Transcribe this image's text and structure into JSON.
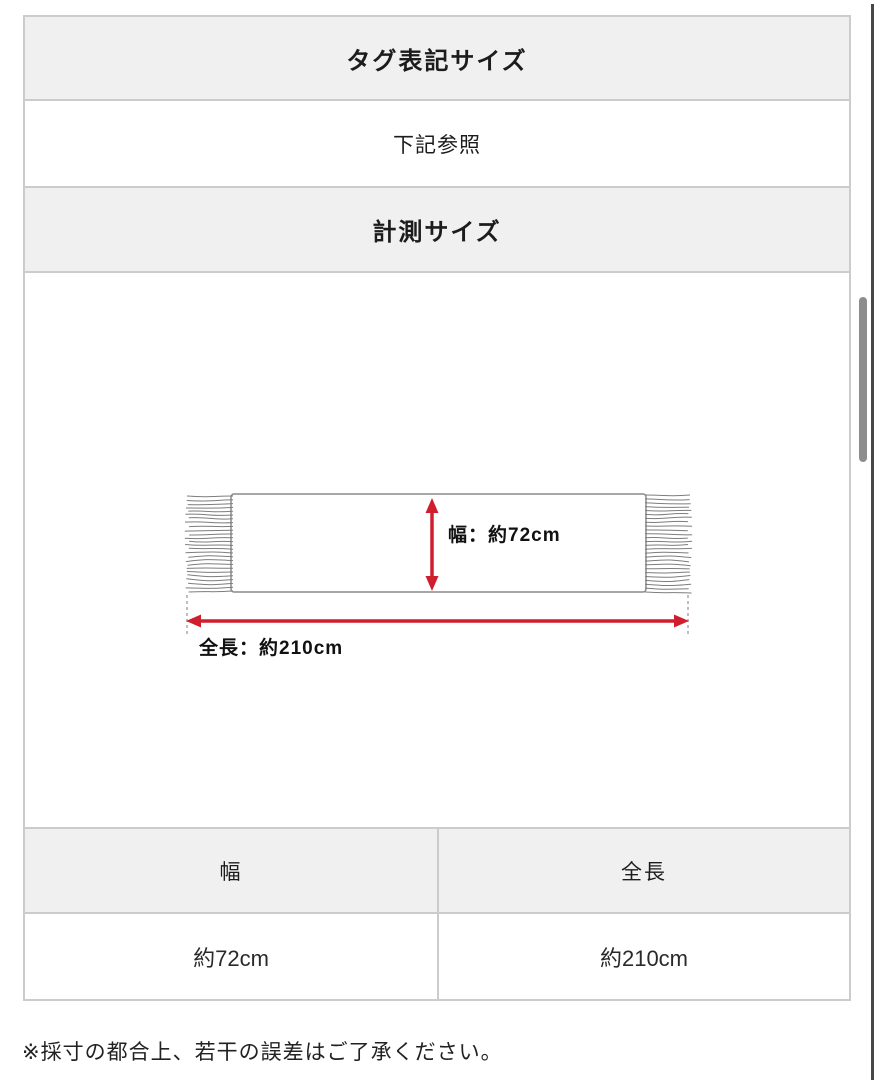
{
  "colors": {
    "section_header_bg": "#f0f0f0",
    "table_border": "#cccccc",
    "arrow_red": "#cf1f2e",
    "scarf_line_gray": "#8a8a8a",
    "scrollbar_thumb": "#8d8d8d",
    "window_right_edge": "#474747"
  },
  "sections": {
    "tag_size_header": "タグ表記サイズ",
    "tag_size_value": "下記参照",
    "measured_size_header": "計測サイズ"
  },
  "diagram": {
    "item": "scarf-with-fringes",
    "width_label": "幅：約72cm",
    "length_label": "全長：約210cm"
  },
  "measurement_table": {
    "headers": [
      "幅",
      "全長"
    ],
    "values": [
      "約72cm",
      "約210cm"
    ]
  },
  "note": "※採寸の都合上、若干の誤差はご了承ください。"
}
